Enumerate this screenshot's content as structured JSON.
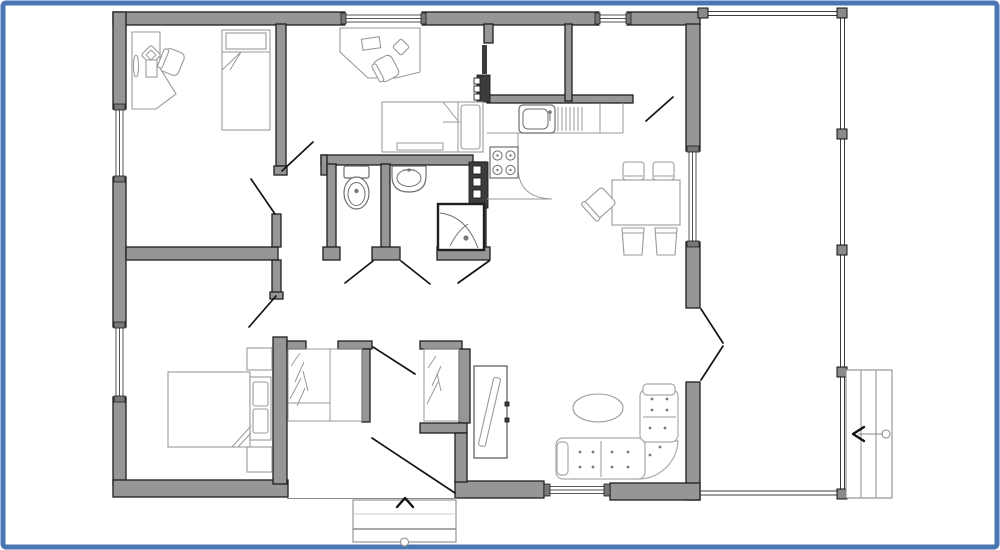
{
  "canvas": {
    "width": 1000,
    "height": 550
  },
  "colors": {
    "background": "#ffffff",
    "frame": "#4a76b4",
    "wall_fill": "#969696",
    "wall_stroke": "#1f1f1f",
    "thin_wall": "#3c3c3c",
    "furniture": "#9a9a9a",
    "fixture": "#6e6e6e",
    "cabinet": "#555555",
    "sofa": "#ababab",
    "tuft_dot": "#7a7a7a",
    "door_swing": "#141414",
    "rail": "#3d3d3d",
    "post_fill": "#8a8a8a",
    "post_stroke": "#111111",
    "glazing": "#555555",
    "window_cap": "#777777",
    "steps_line": "#8c8c8c",
    "steps_faint": "#cfcfcf",
    "arrow": "#111111",
    "tv_screen": "#ededed"
  },
  "symbols": {
    "entry_direction_arrow": "chevron-up",
    "outdoor_stairs_arrow": "left",
    "outdoor_stairs_treads": 3,
    "porch_posts": 6,
    "wardrobe_mark": "hanger-slashes"
  },
  "rooms": [
    "office",
    "small-bedroom",
    "master-bedroom",
    "wc",
    "bathroom",
    "kitchen",
    "dining-area",
    "living-room",
    "hallway",
    "entrance-hall",
    "storage-room",
    "utility-room",
    "porch"
  ],
  "furniture_symbols": [
    "desk",
    "office-chair",
    "single-bed",
    "double-bed",
    "nightstand",
    "wardrobe",
    "toilet",
    "washbasin",
    "shower-cabin",
    "kitchen-sink",
    "stove",
    "dining-table",
    "dining-chair",
    "corner-sofa",
    "coffee-table",
    "tv-cabinet",
    "entrance-steps",
    "porch-stairs"
  ]
}
